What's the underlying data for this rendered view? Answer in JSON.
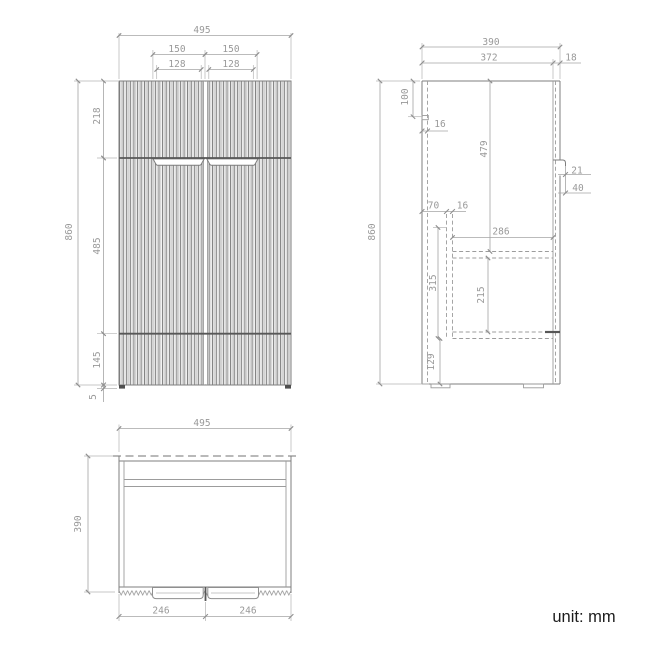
{
  "colors": {
    "background": "#ffffff",
    "drawing_lines": "#7f7f7f",
    "dimension_lines": "#a4a4a4",
    "dimension_text": "#999999",
    "dark_accents": "#575757",
    "unit_text": "#1c1c1c"
  },
  "front_view": {
    "width_total": "495",
    "handle_span_left": "150",
    "handle_span_right": "150",
    "recess_left": "128",
    "recess_right": "128",
    "top_to_handles": "218",
    "height_total": "860",
    "handles_to_plinth": "485",
    "plinth_height": "145",
    "foot_height": "5"
  },
  "side_view": {
    "depth_total": "390",
    "carcass_depth": "372",
    "door_thickness": "18",
    "top_offset": "100",
    "panel_thickness": "16",
    "top_to_shelf": "479",
    "handle_lip": "21",
    "handle_groove": "40",
    "back_offset": "70",
    "runner_thickness": "16",
    "interior_depth": "286",
    "runner_height": "315",
    "shelf_to_base": "215",
    "base_height": "129",
    "height_total": "860"
  },
  "plan_view": {
    "width_total": "495",
    "depth_total": "390",
    "door_left_width": "246",
    "door_right_width": "246"
  },
  "note": {
    "unit_label": "unit: mm"
  }
}
